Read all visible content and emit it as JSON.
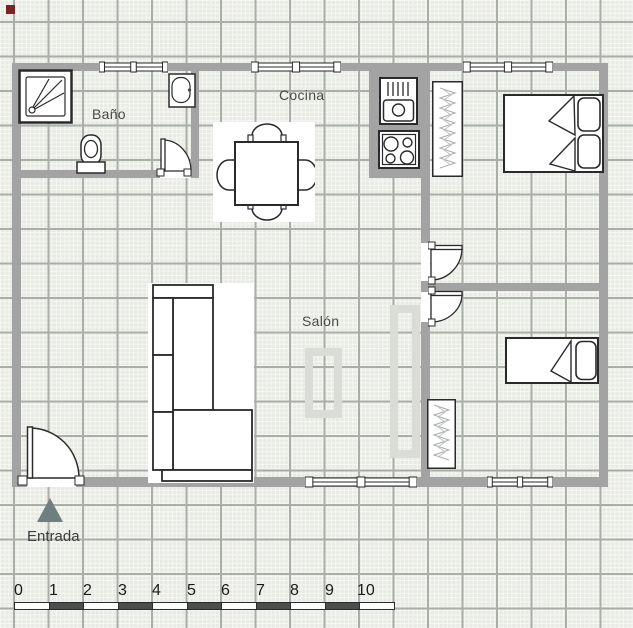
{
  "floorplan": {
    "room_labels": {
      "bathroom": "Baño",
      "kitchen": "Cocina",
      "living_room": "Salón"
    },
    "entrance_label": "Entrada",
    "furniture_icons": [
      "shower",
      "toilet",
      "washbasin",
      "interior-door",
      "entrance-door",
      "window",
      "dining-table-with-chairs",
      "kitchen-sink",
      "stove-4-burners",
      "wardrobe",
      "double-bed",
      "single-bed",
      "corner-sofa",
      "ghost-furniture-outline"
    ],
    "colors": {
      "wall": "#a3a3a3",
      "background": "#e8eae4",
      "grid_major": "#a9aea9",
      "grid_fine": "#f6f7f4",
      "entrance_arrow": "#6f7f7f",
      "faint_outline": "#dadcd8",
      "origin_marker": "#7b2323",
      "ruler_dark": "#4d4d4d"
    }
  },
  "ruler": {
    "numbers": [
      "0",
      "1",
      "2",
      "3",
      "4",
      "5",
      "6",
      "7",
      "8",
      "9",
      "10"
    ]
  }
}
